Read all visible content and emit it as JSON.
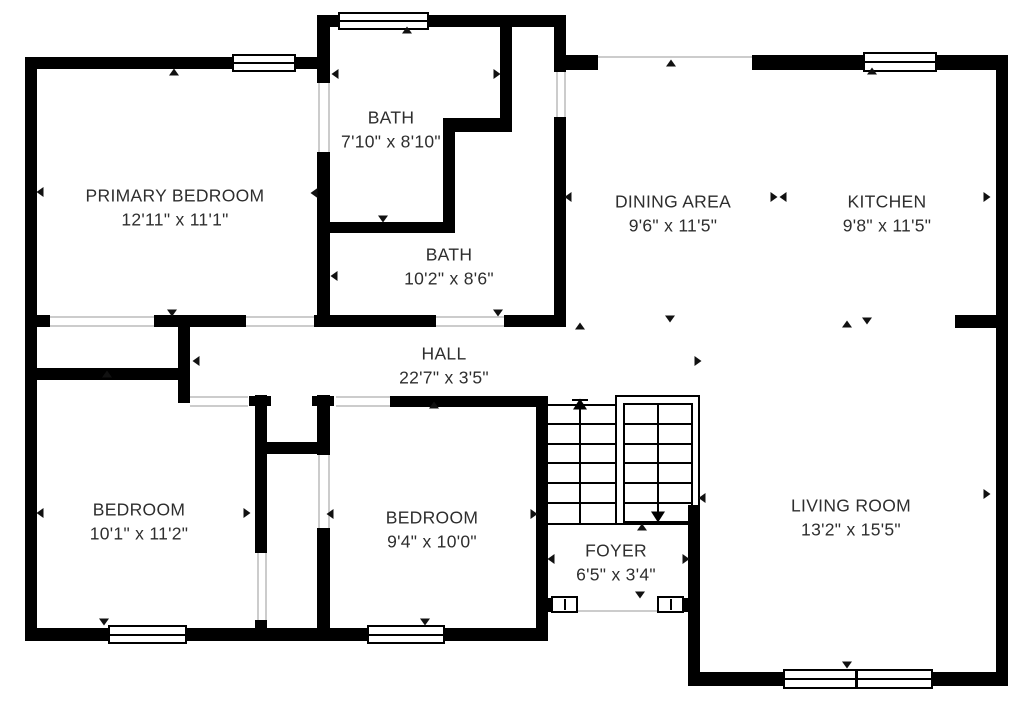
{
  "plan": {
    "type": "floor-plan",
    "background": "#ffffff",
    "wall_color": "#000000",
    "opening_color": "#cccccc",
    "text_color": "#2e2e2e",
    "rooms": [
      {
        "key": "primary-bedroom",
        "name": "PRIMARY BEDROOM",
        "dims": "12'11\" x 11'1\"",
        "cx": 175,
        "cy": 208
      },
      {
        "key": "bath-ensuite",
        "name": "BATH",
        "dims": "7'10\" x 8'10\"",
        "cx": 391,
        "cy": 130
      },
      {
        "key": "bath-hall",
        "name": "BATH",
        "dims": "10'2\" x 8'6\"",
        "cx": 449,
        "cy": 267
      },
      {
        "key": "dining-area",
        "name": "DINING AREA",
        "dims": "9'6\" x 11'5\"",
        "cx": 673,
        "cy": 214
      },
      {
        "key": "kitchen",
        "name": "KITCHEN",
        "dims": "9'8\" x 11'5\"",
        "cx": 887,
        "cy": 214
      },
      {
        "key": "hall",
        "name": "HALL",
        "dims": "22'7\" x 3'5\"",
        "cx": 444,
        "cy": 366
      },
      {
        "key": "bedroom-left",
        "name": "BEDROOM",
        "dims": "10'1\" x 11'2\"",
        "cx": 139,
        "cy": 522
      },
      {
        "key": "bedroom-middle",
        "name": "BEDROOM",
        "dims": "9'4\" x 10'0\"",
        "cx": 432,
        "cy": 530
      },
      {
        "key": "foyer",
        "name": "FOYER",
        "dims": "6'5\" x 3'4\"",
        "cx": 616,
        "cy": 563
      },
      {
        "key": "living-room",
        "name": "LIVING ROOM",
        "dims": "13'2\" x 15'5\"",
        "cx": 851,
        "cy": 518
      }
    ],
    "walls": [
      [
        25,
        57,
        12,
        584
      ],
      [
        25,
        57,
        292,
        12
      ],
      [
        317,
        15,
        249,
        12
      ],
      [
        554,
        15,
        12,
        57
      ],
      [
        554,
        117,
        12,
        210
      ],
      [
        566,
        55,
        32,
        15
      ],
      [
        752,
        55,
        256,
        15
      ],
      [
        996,
        55,
        12,
        631
      ],
      [
        688,
        672,
        320,
        14
      ],
      [
        688,
        505,
        12,
        181
      ],
      [
        538,
        598,
        40,
        14
      ],
      [
        657,
        598,
        43,
        14
      ],
      [
        25,
        628,
        523,
        13
      ],
      [
        536,
        396,
        12,
        245
      ],
      [
        390,
        396,
        158,
        11
      ],
      [
        249,
        396,
        22,
        10
      ],
      [
        312,
        396,
        22,
        10
      ],
      [
        255,
        395,
        12,
        158
      ],
      [
        255,
        620,
        12,
        21
      ],
      [
        317,
        395,
        13,
        60
      ],
      [
        317,
        528,
        13,
        113
      ],
      [
        263,
        442,
        59,
        12
      ],
      [
        25,
        315,
        25,
        12
      ],
      [
        154,
        315,
        92,
        12
      ],
      [
        314,
        315,
        122,
        12
      ],
      [
        504,
        315,
        62,
        12
      ],
      [
        25,
        368,
        153,
        12
      ],
      [
        178,
        315,
        12,
        88
      ],
      [
        317,
        15,
        13,
        68
      ],
      [
        317,
        152,
        13,
        175
      ],
      [
        443,
        118,
        69,
        14
      ],
      [
        443,
        118,
        12,
        115
      ],
      [
        500,
        15,
        12,
        103
      ],
      [
        317,
        222,
        138,
        11
      ],
      [
        955,
        315,
        53,
        13
      ]
    ],
    "windows": [
      {
        "x": 232,
        "y": 54,
        "w": 64,
        "h": 18,
        "divider": "h"
      },
      {
        "x": 338,
        "y": 12,
        "w": 91,
        "h": 18,
        "divider": "h"
      },
      {
        "x": 863,
        "y": 52,
        "w": 74,
        "h": 20,
        "divider": "h"
      },
      {
        "x": 108,
        "y": 625,
        "w": 79,
        "h": 19,
        "divider": "h"
      },
      {
        "x": 367,
        "y": 625,
        "w": 78,
        "h": 19,
        "divider": "h"
      },
      {
        "x": 783,
        "y": 669,
        "w": 74,
        "h": 20,
        "divider": "h"
      },
      {
        "x": 856,
        "y": 669,
        "w": 77,
        "h": 20,
        "divider": "h"
      },
      {
        "x": 551,
        "y": 596,
        "w": 27,
        "h": 17,
        "divider": "v"
      },
      {
        "x": 657,
        "y": 596,
        "w": 27,
        "h": 17,
        "divider": "v"
      }
    ],
    "opening_lines": [
      [
        598,
        56,
        154,
        2
      ],
      [
        50,
        316,
        104,
        2
      ],
      [
        50,
        325,
        104,
        2
      ],
      [
        246,
        316,
        68,
        2
      ],
      [
        246,
        325,
        68,
        2
      ],
      [
        436,
        316,
        68,
        2
      ],
      [
        436,
        325,
        68,
        2
      ],
      [
        556,
        72,
        2,
        45
      ],
      [
        564,
        72,
        2,
        45
      ],
      [
        318,
        83,
        2,
        69
      ],
      [
        328,
        83,
        2,
        69
      ],
      [
        318,
        455,
        2,
        73
      ],
      [
        328,
        455,
        2,
        73
      ],
      [
        257,
        553,
        2,
        67
      ],
      [
        265,
        553,
        2,
        67
      ],
      [
        190,
        396,
        58,
        2
      ],
      [
        190,
        405,
        58,
        2
      ],
      [
        336,
        396,
        54,
        2
      ],
      [
        336,
        405,
        54,
        2
      ],
      [
        578,
        610,
        79,
        2
      ]
    ],
    "markers": [
      {
        "x": 174,
        "y": 72,
        "dir": "up"
      },
      {
        "x": 407,
        "y": 30,
        "dir": "up"
      },
      {
        "x": 671,
        "y": 63,
        "dir": "up"
      },
      {
        "x": 872,
        "y": 71,
        "dir": "up"
      },
      {
        "x": 580,
        "y": 326,
        "dir": "up"
      },
      {
        "x": 847,
        "y": 324,
        "dir": "up"
      },
      {
        "x": 107,
        "y": 374,
        "dir": "up"
      },
      {
        "x": 434,
        "y": 405,
        "dir": "up"
      },
      {
        "x": 642,
        "y": 527,
        "dir": "up"
      },
      {
        "x": 172,
        "y": 313,
        "dir": "down"
      },
      {
        "x": 498,
        "y": 313,
        "dir": "down"
      },
      {
        "x": 670,
        "y": 319,
        "dir": "down"
      },
      {
        "x": 867,
        "y": 321,
        "dir": "down"
      },
      {
        "x": 104,
        "y": 622,
        "dir": "down"
      },
      {
        "x": 425,
        "y": 622,
        "dir": "down"
      },
      {
        "x": 847,
        "y": 665,
        "dir": "down"
      },
      {
        "x": 640,
        "y": 595,
        "dir": "down"
      },
      {
        "x": 383,
        "y": 219,
        "dir": "down"
      },
      {
        "x": 40,
        "y": 192,
        "dir": "left"
      },
      {
        "x": 314,
        "y": 193,
        "dir": "left"
      },
      {
        "x": 335,
        "y": 74,
        "dir": "left"
      },
      {
        "x": 568,
        "y": 197,
        "dir": "left"
      },
      {
        "x": 334,
        "y": 276,
        "dir": "left"
      },
      {
        "x": 330,
        "y": 514,
        "dir": "left"
      },
      {
        "x": 702,
        "y": 498,
        "dir": "left"
      },
      {
        "x": 551,
        "y": 559,
        "dir": "left"
      },
      {
        "x": 40,
        "y": 513,
        "dir": "left"
      },
      {
        "x": 196,
        "y": 361,
        "dir": "left"
      },
      {
        "x": 783,
        "y": 197,
        "dir": "left"
      },
      {
        "x": 497,
        "y": 74,
        "dir": "right"
      },
      {
        "x": 987,
        "y": 197,
        "dir": "right"
      },
      {
        "x": 247,
        "y": 513,
        "dir": "right"
      },
      {
        "x": 698,
        "y": 361,
        "dir": "right"
      },
      {
        "x": 987,
        "y": 494,
        "dir": "right"
      },
      {
        "x": 686,
        "y": 559,
        "dir": "right"
      },
      {
        "x": 534,
        "y": 514,
        "dir": "right"
      },
      {
        "x": 774,
        "y": 197,
        "dir": "right"
      }
    ],
    "stairs": {
      "left_flight": {
        "x": 548,
        "w": 67,
        "tread_ys": [
          404,
          423,
          443,
          462,
          482,
          502,
          523
        ]
      },
      "outer_box": [
        615,
        395,
        85,
        130
      ],
      "inner_box": [
        623,
        403,
        70,
        120
      ],
      "inner_tread_ys": [
        423,
        443,
        462,
        482,
        502
      ],
      "up_arrow": {
        "x": 580,
        "line_y1": 408,
        "line_y2": 523,
        "head_y": 404,
        "bar_y": 399
      },
      "down_arrow": {
        "x": 658,
        "line_y1": 405,
        "line_y2": 512,
        "head_y": 517
      }
    }
  }
}
